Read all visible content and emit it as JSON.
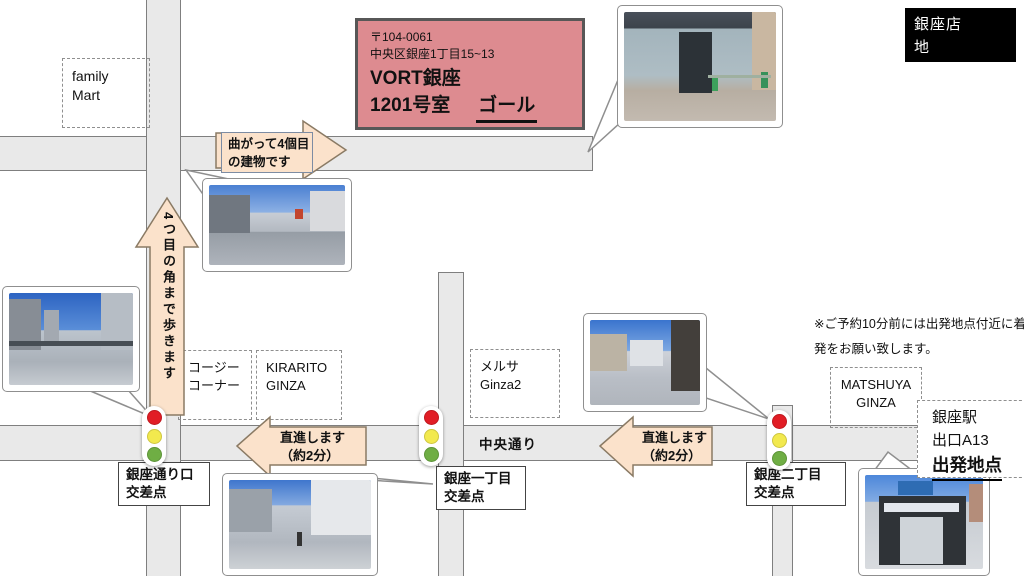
{
  "map_header": {
    "store_label": "銀座店　　地\n図　No.06"
  },
  "goal_box": {
    "postal_code": "〒104-0061",
    "address": "中央区銀座1丁目15~13",
    "building_name": "VORT銀座",
    "room": "1201号室",
    "goal_label": "ゴール"
  },
  "note": "※ご予約10分前には出発地点付近に着き、出\n発をお願い致します。",
  "street_label": "中央通り",
  "landmarks": {
    "family_mart": "family\nMart",
    "cozy_corner": "コージー\nコーナー",
    "kirarito": "KIRARITO\nGINZA",
    "melsa": "メルサ\nGinza2",
    "matsuya": "MATSHUYA\nGINZA"
  },
  "start_point": {
    "station": "銀座駅",
    "exit": "出口A13",
    "label": "出発地点"
  },
  "directions": {
    "turn": "曲がって4個目\nの建物です",
    "walk": "4つ目の角まで歩きます",
    "straight1": "直進します\n（約2分）",
    "straight2": "直進します\n（約2分）"
  },
  "intersections": {
    "ginza_dori_guchi": "銀座通り口\n交差点",
    "ginza_1chome": "銀座一丁目\n交差点",
    "ginza_2chome": "銀座二丁目\n交差点"
  },
  "colors": {
    "goal_bg": "#dd8b90",
    "arrow_fill": "#fbe2cb",
    "street_fill": "#e9e9e9",
    "title_bg": "#000000",
    "signal_red": "#e11d25",
    "signal_yellow": "#f2e94e",
    "signal_green": "#6fae44"
  }
}
